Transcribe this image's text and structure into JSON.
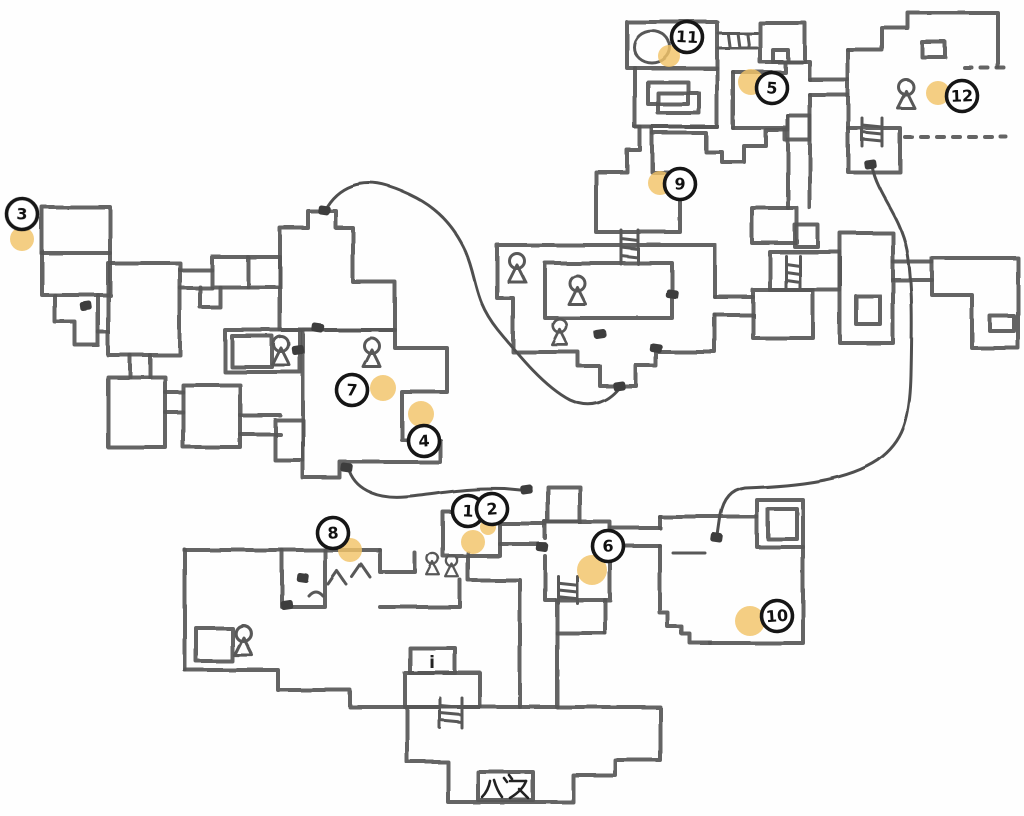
{
  "map": {
    "colors": {
      "wall": "#575757",
      "paper": "#fefefe",
      "marker_stroke": "#161616",
      "highlight_dot": "#f2c368",
      "door": "#3e3e3e"
    },
    "labels": {
      "bus": "バス",
      "info": "i"
    },
    "markers": [
      {
        "n": "1",
        "x": 468,
        "y": 511
      },
      {
        "n": "2",
        "x": 492,
        "y": 509
      },
      {
        "n": "3",
        "x": 22,
        "y": 214
      },
      {
        "n": "4",
        "x": 424,
        "y": 441
      },
      {
        "n": "5",
        "x": 772,
        "y": 88
      },
      {
        "n": "6",
        "x": 608,
        "y": 546
      },
      {
        "n": "7",
        "x": 352,
        "y": 390
      },
      {
        "n": "8",
        "x": 333,
        "y": 533
      },
      {
        "n": "9",
        "x": 680,
        "y": 184
      },
      {
        "n": "10",
        "x": 777,
        "y": 616
      },
      {
        "n": "11",
        "x": 687,
        "y": 37
      },
      {
        "n": "12",
        "x": 962,
        "y": 96
      }
    ],
    "highlight_dots": [
      {
        "x": 473,
        "y": 542,
        "r": 12
      },
      {
        "x": 488,
        "y": 527,
        "r": 8
      },
      {
        "x": 22,
        "y": 239,
        "r": 12
      },
      {
        "x": 421,
        "y": 414,
        "r": 13
      },
      {
        "x": 751,
        "y": 82,
        "r": 13
      },
      {
        "x": 592,
        "y": 570,
        "r": 15
      },
      {
        "x": 383,
        "y": 388,
        "r": 13
      },
      {
        "x": 350,
        "y": 550,
        "r": 12
      },
      {
        "x": 660,
        "y": 183,
        "r": 12
      },
      {
        "x": 750,
        "y": 621,
        "r": 15
      },
      {
        "x": 669,
        "y": 56,
        "r": 11
      },
      {
        "x": 938,
        "y": 93,
        "r": 12
      }
    ],
    "persons": [
      {
        "x": 281,
        "y": 344,
        "s": 1
      },
      {
        "x": 372,
        "y": 346,
        "s": 1
      },
      {
        "x": 517,
        "y": 261,
        "s": 1
      },
      {
        "x": 577,
        "y": 283,
        "s": 1
      },
      {
        "x": 560,
        "y": 326,
        "s": 0.9
      },
      {
        "x": 906,
        "y": 87,
        "s": 1
      },
      {
        "x": 243,
        "y": 633,
        "s": 1.05
      },
      {
        "x": 433,
        "y": 559,
        "s": 0.75
      },
      {
        "x": 452,
        "y": 561,
        "s": 0.75
      }
    ],
    "ladders": [
      {
        "x": 718,
        "y": 33,
        "w": 39,
        "h": 15,
        "o": "h"
      },
      {
        "x": 621,
        "y": 230,
        "w": 17,
        "h": 34,
        "o": "v"
      },
      {
        "x": 786,
        "y": 256,
        "w": 14,
        "h": 32,
        "o": "v"
      },
      {
        "x": 558,
        "y": 576,
        "w": 19,
        "h": 27,
        "o": "v"
      },
      {
        "x": 440,
        "y": 698,
        "w": 22,
        "h": 30,
        "o": "v"
      },
      {
        "x": 862,
        "y": 118,
        "w": 20,
        "h": 28,
        "o": "v"
      }
    ],
    "doors": [
      {
        "x": 318,
        "y": 328
      },
      {
        "x": 298,
        "y": 350
      },
      {
        "x": 347,
        "y": 468
      },
      {
        "x": 619,
        "y": 386
      },
      {
        "x": 324,
        "y": 210
      },
      {
        "x": 527,
        "y": 490
      },
      {
        "x": 717,
        "y": 538
      },
      {
        "x": 870,
        "y": 164
      },
      {
        "x": 672,
        "y": 294
      },
      {
        "x": 600,
        "y": 334
      },
      {
        "x": 656,
        "y": 348
      },
      {
        "x": 86,
        "y": 306
      },
      {
        "x": 303,
        "y": 578
      },
      {
        "x": 287,
        "y": 605
      },
      {
        "x": 542,
        "y": 547
      }
    ],
    "bathtub": {
      "cx": 652,
      "cy": 47,
      "rx": 18,
      "ry": 16
    },
    "bench": {
      "x1": 673,
      "y1": 553,
      "x2": 705,
      "y2": 553
    },
    "chevrons": [
      "M328,584 L337,571 L346,584",
      "M352,577 L361,564 L370,577",
      "M309,596 Q316,588 323,596"
    ],
    "wires": [
      "M325,210 C338,186 362,178 388,186 C432,200 452,222 466,252 C478,280 474,300 498,330 C520,357 545,387 570,400 C590,409 607,403 619,388",
      "M350,472 C358,492 380,499 405,497 C440,494 460,488 505,489 L526,491",
      "M872,168 C878,195 900,215 907,250 C913,285 912,330 911,375 C910,420 903,442 878,460 C848,480 800,486 745,488 C731,490 724,500 721,515 L718,536"
    ],
    "walls": [
      "M627,22 H717 V68 H627 Z",
      "M635,68 V127 H717 V68",
      "M648,82 H688 V104 H648 Z",
      "M658,93 H699 V113 H658 Z",
      "M760,23 H805 V62 H760 Z",
      "M773,50 H788 V62 H773 Z",
      "M733,72 H785 V62 H810 V80",
      "M733,128 H785 V140 H810 V95",
      "M733,72 V128",
      "M810,80 H848",
      "M810,95 H848",
      "M848,50 H882 V28 H908 V13 H998 V67",
      "M848,50 V128",
      "M922,42 H945 V57 H922 Z",
      "M848,128 H900 V172 H848 Z",
      "M652,127 H717",
      "M635,127 H640",
      "M640,127 V150 H627 V172 H596 V232 H680 V172 H652 V127",
      "M652,133 H706 V152 H722 V162 H744 V146 H766 V130 H788 V116",
      "M788,116 H810",
      "M788,116 V208",
      "M810,116 V208",
      "M752,208 H797 V243 H752 Z",
      "M795,225 H818 V247 H795 Z",
      "M770,252 H840 V290 H770 Z",
      "M753,290 H813 V338 H753 Z",
      "M840,233 H893 V343 H840 Z",
      "M856,296 H880 V324 H856 Z",
      "M893,262 H932",
      "M893,280 H932",
      "M932,258 H1018 V348 H972 V295 H932 Z",
      "M990,316 H1014 V331 H990 Z",
      "M715,297 V245 H497 V298 H513 V352 H578 V366 H600 V386 H636 V366 H656 V352 H715 V315",
      "M545,263 H672 V318 H545 Z",
      "M715,297 H753",
      "M715,315 H753",
      "M42,207 H110 V295 H42 Z",
      "M42,253 H110",
      "M55,295 V322 L75,322 L75,345 L98,345 L98,295",
      "M98,332 H108",
      "M108,263 H180 V355 H108 Z",
      "M180,270 H212",
      "M180,288 H212",
      "M212,257 H280 V287 H212 Z",
      "M248,257 V287",
      "M200,287 V307 H220 V287",
      "M130,355 V377",
      "M150,355 V377",
      "M108,377 H165 V447 H108 Z",
      "M165,392 H183",
      "M165,412 H183",
      "M183,385 H240 V447 H183 Z",
      "M240,415 H280",
      "M240,434 H280",
      "M225,330 H300 V372 H225 Z",
      "M232,336 H272 V367 H232 Z",
      "M280,228 H308 V211 H336 V228 H353 V282 H395 V330 H280 Z",
      "M303,330 H395 V348 H447 V392 H402 V440 H440 V462 H340 V478 H303 Z",
      "M275,420 H303 V460 H275 Z",
      "M443,512 H500 V556 H443 Z",
      "M500,524 H545",
      "M500,544 H545",
      "M380,550 V572 H415 V553",
      "M380,607 H460 V580",
      "M468,553 V580 H520 V707",
      "M557,633 V707",
      "M557,633 H605",
      "M557,600 V633",
      "M605,600 V633",
      "M545,522 H610 V600 H545 V556",
      "M545,538 V522",
      "M548,487 H580 V522 H548 Z",
      "M610,528 H660",
      "M610,546 H660",
      "M660,517 H757",
      "M803,547 V643 H710",
      "M710,643 H690 V634 H682 V627 H668 V613 H660 V546",
      "M660,528 V517",
      "M757,500 H803 V547 H757 Z",
      "M768,509 H797 V539 H768 Z",
      "M185,550 H380",
      "M185,550 V670",
      "M185,670 H278 V690 H350 V707 H407",
      "M282,550 V607 H325 V550",
      "M196,628 H232 V661 H196 Z",
      "M410,648 H455 V673 H410 Z",
      "M405,673 H480 V707 H405 Z",
      "M407,707 V762 H448 V802 H573 V775 H615 V760 H660 V707 Z",
      "M478,772 H533 V800 H478 Z"
    ],
    "dashed_walls": [
      "M965,68 H1012",
      "M905,137 H1006"
    ]
  }
}
